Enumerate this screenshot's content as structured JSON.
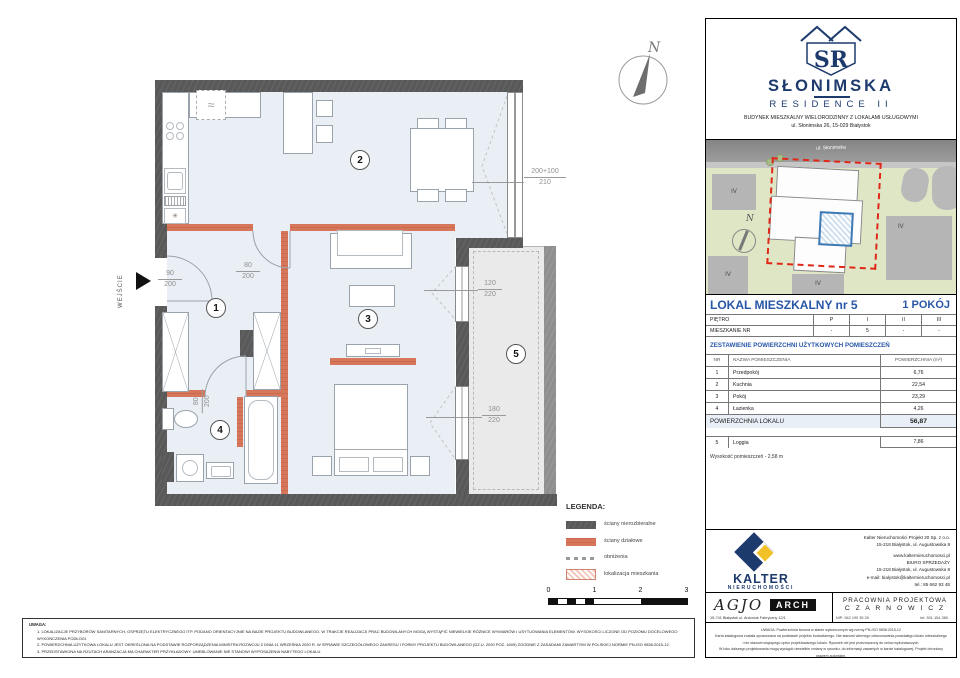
{
  "colors": {
    "wall_dark": "#595959",
    "wall_partition": "#d6775c",
    "floor": "#e9eff5",
    "loggia_floor": "#eaeaea",
    "brand_navy": "#1d3a6d",
    "table_blue": "#2857a8",
    "boundary_red": "#e02818",
    "kalter_yellow": "#f2c128",
    "site_green": "#dfe6c5",
    "unit_highlight_blue": "#3b78b4"
  },
  "brand": {
    "monogram": "SR",
    "name": "SŁONIMSKA",
    "subname": "RESIDENCE II",
    "desc1": "BUDYNEK MIESZKALNY WIELORODZINNY Z LOKALAMI USŁUGOWYMI",
    "desc2": "ul. Słonimska 26, 15-029 Białystok"
  },
  "siteplan": {
    "street_label": "ul. Słonimska",
    "north_label": "N",
    "block_labels": [
      "IV",
      "IV",
      "IV",
      "IV"
    ]
  },
  "unit": {
    "title": "LOKAL MIESZKALNY  nr 5",
    "type": "1 POKÓJ"
  },
  "floors_table": {
    "row1": {
      "label": "PIĘTRO",
      "c1": "P",
      "c2": "I",
      "c3": "II",
      "c4": "III"
    },
    "row2": {
      "label": "MIESZKANIE NR",
      "c1": "-",
      "c2": "5",
      "c3": "-",
      "c4": "-"
    }
  },
  "areas": {
    "section_title": "ZESTAWIENIE POWIERZCHNI UŻYTKOWYCH POMIESZCZEŃ",
    "col_nr": "NR",
    "col_name": "NAZWA POMIESZCZENIA",
    "col_area": "POWIERZCHNIA (m²)",
    "rows": [
      {
        "nr": "1",
        "name": "Przedpokój",
        "area": "6,76"
      },
      {
        "nr": "2",
        "name": "Kuchnia",
        "area": "22,54"
      },
      {
        "nr": "3",
        "name": "Pokój",
        "area": "23,29"
      },
      {
        "nr": "4",
        "name": "Łazienka",
        "area": "4,26"
      }
    ],
    "total_label": "POWIERZCHNIA LOKALU",
    "total_value": "56,87",
    "loggia": {
      "nr": "5",
      "name": "Loggia",
      "area": "7,86"
    },
    "height_note": "Wysokość pomieszczeń - 2,58 m"
  },
  "kalter": {
    "name": "KALTER",
    "sub": "nieruchomości",
    "lines": [
      "Kalter Nieruchomości Projekt 20  Sp. z o.o.",
      "15-218 Białystok, ul. Augustowska 8",
      "www.kalternieruchomosci.pl",
      "BIURO SPRZEDAŻY",
      "15-218 Białystok, ul. Augustowska 8",
      "e-mail: bialystok@kalternieruchomosci.pl",
      "tel.: 85 662 93 48"
    ]
  },
  "agio": {
    "name": "AGJO",
    "tag": "ARCH",
    "address": "15-741 Białystok    ul. Antoniuk Fabryczny  12/1"
  },
  "pracownia": {
    "line1": "PRACOWNIA PROJEKTOWA",
    "line2": "C Z A R N O W I C Z",
    "nip": "NIP:  542 199 35 28",
    "tel": "tel. 501-154-380"
  },
  "fineprint": {
    "lines": [
      "UWAGA:  Powierzchnia liczona w stanie wykończonym wg normy PN-ISO 9836:2015-12",
      "Karta katalogowa została opracowana na podstawie projektu budowlanego. Nie stanowi wiernego odwzorowania powstałego lokalu mieszkalnego",
      "i nie stanowi wiążącego opisu projektowanego lokalu. Rysunek nie jest przeznaczony do celów wykonawczych.",
      "W toku dalszego projektowania mogą wystąpić niewielkie zmiany w rysunku, do informacji zawartych w karcie katalogowej. Projekt chroniony prawem autorskim."
    ]
  },
  "notes": {
    "title": "UWAGA:",
    "items": [
      "1.    LOKALIZACJE PRZYBORÓW SANITARNYCH, OSPRZĘTU ELEKTRYCZNEGO ITP. PODANO ORIENTACYJNIE NA BAZIE PROJEKTU BUDOWLANEGO. W TRAKCIE REALIZACJI PRAC BUDOWLANYCH MOGĄ WYSTĄPIĆ NIEWIELKIE RÓŻNICE WYMIARÓW I USYTUOWANIA ELEMENTÓW. WYSOKOŚCI LICZONE OD POZIOMU DOCELOWEGO WYKOŃCZENIA PODŁOGI.",
      "2.    POWIERZCHNIA UŻYTKOWA LOKALU JEST OKREŚLONA NA PODSTAWIE ROZPORZĄDZENIA MINISTRA ROZWOJU Z DNIA 11 WRZEŚNIA 2020 R. W SPRAWIE SZCZEGÓŁOWEGO ZAKRESU I FORMY PROJEKTU BUDOWLANEGO (DZ.U. 2020 POZ. 1609) ZGODNIE Z ZASADAMI ZAWARTYMI W POLSKIEJ NORMIE PN-ISO 9836:2015-12.",
      "3.    PRZEDSTAWIONA NA RZUTACH ARANŻACJA MA CHARAKTER PRZYKŁADOWY. UMEBLOWANIE NIE STANOWI WYPOSAŻENIA NABYTEGO LOKALU."
    ]
  },
  "plan": {
    "entrance_label": "WEJŚCIE",
    "north_label": "N",
    "stove_symbol": "≈",
    "fridge_symbol": "✳",
    "room_markers": [
      "1",
      "2",
      "3",
      "4",
      "5"
    ],
    "dims": {
      "entrance_door": {
        "top": "90",
        "bottom": "200"
      },
      "room_door": {
        "top": "80",
        "bottom": "200"
      },
      "bath_door": {
        "top": "80",
        "bottom": "200"
      },
      "kitchen_window": {
        "top": "200+100",
        "bottom": "210"
      },
      "loggia_window_small": {
        "top": "120",
        "bottom": "220"
      },
      "loggia_window_large": {
        "top": "180",
        "bottom": "220"
      }
    },
    "legend": {
      "title": "LEGENDA:",
      "items": [
        {
          "label": "ściany nierozbieralne"
        },
        {
          "label": "ściany działowe"
        },
        {
          "label": "obniżenia"
        },
        {
          "label": "lokalizacja mieszkania"
        }
      ]
    },
    "scale_ticks": [
      "0",
      "1",
      "2",
      "3"
    ]
  }
}
